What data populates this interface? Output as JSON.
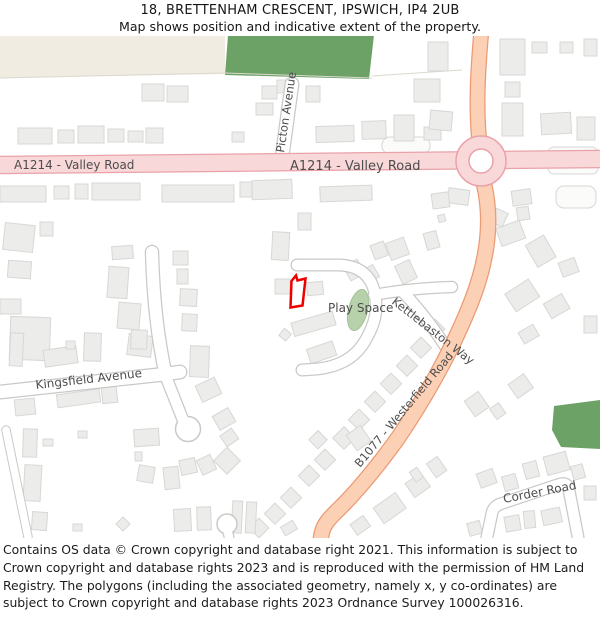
{
  "header": {
    "title": "18, BRETTENHAM CRESCENT, IPSWICH, IP4 2UB",
    "subtitle": "Map shows position and indicative extent of the property."
  },
  "map": {
    "labels": {
      "valley_road_left": "A1214 - Valley Road",
      "valley_road_center": "A1214 - Valley Road",
      "picton_avenue": "Picton Avenue",
      "play_space": "Play Space",
      "kettlebaston_way": "Kettlebaston Way",
      "kingsfield_avenue": "Kingsfield Avenue",
      "westerfield_road": "B1077 - Westerfield Road",
      "corder_road": "Corder Road"
    },
    "colors": {
      "primary_road_fill": "#f9d8da",
      "primary_road_stroke": "#e9a2a8",
      "b_road_fill": "#fbd0b5",
      "b_road_stroke": "#eb9a74",
      "green_area": "#6da267",
      "play_green": "#b7d2ab",
      "residential_area": "#f1ece1",
      "building_fill": "#ececeb",
      "building_stroke": "#d7d7d5",
      "road_casing": "#c9c9c7",
      "plot_outline": "#ee0000",
      "label_color": "#4d4d4d"
    }
  },
  "footer": {
    "text": "Contains OS data © Crown copyright and database right 2021. This information is subject to Crown copyright and database rights 2023 and is reproduced with the permission of HM Land Registry. The polygons (including the associated geometry, namely x, y co-ordinates) are subject to Crown copyright and database rights 2023 Ordnance Survey 100026316."
  }
}
